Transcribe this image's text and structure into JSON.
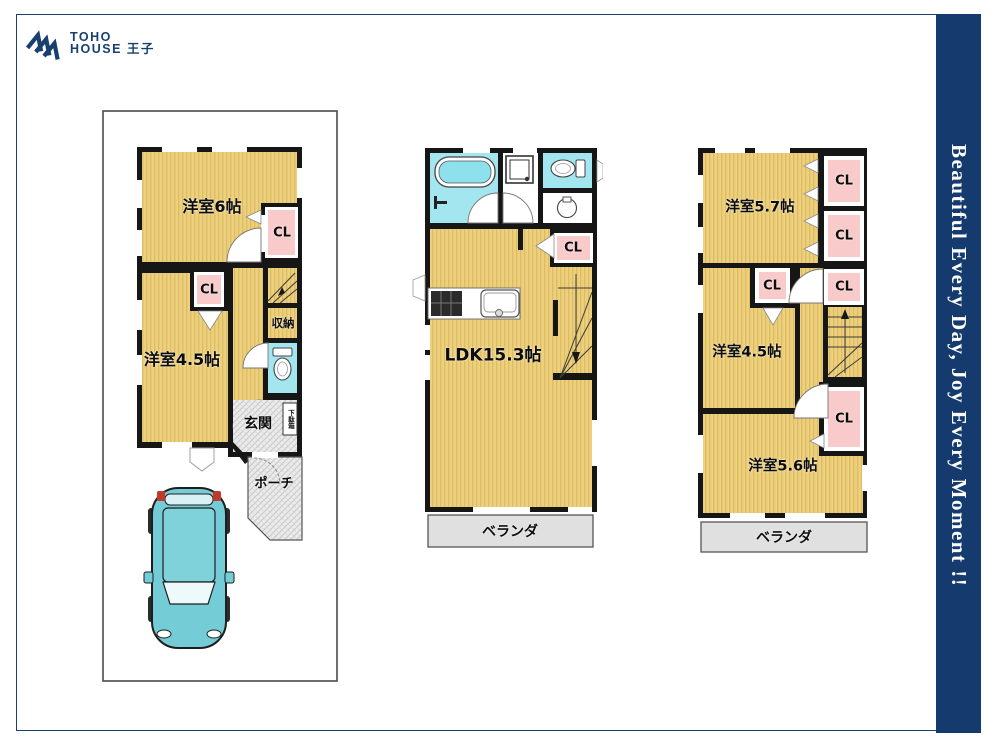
{
  "brand": {
    "line1": "TOHO",
    "line2": "HOUSE 王子"
  },
  "side_banner": {
    "text": "Beautiful  Every Day, Joy Every Moment !!"
  },
  "colors": {
    "navy": "#143a6e",
    "wall": "#161616",
    "room_floor": "#edd07e",
    "room_stripe": "#debd62",
    "closet_pink": "#f8caca",
    "water_cyan": "#a4e6ef",
    "veranda_gray": "#e0e0e0",
    "car_teal": "#74ccd6"
  },
  "floor1": {
    "room6": "洋室6帖",
    "closets": [
      "CL",
      "CL"
    ],
    "room45": "洋室4.5帖",
    "storage": "収納",
    "entrance": "玄関",
    "shoebox": "下駄箱",
    "porch": "ポーチ"
  },
  "floor2": {
    "ldk": "LDK15.3帖",
    "closet": "CL",
    "veranda": "ベランダ"
  },
  "floor3": {
    "room57": "洋室5.7帖",
    "closets": [
      "CL",
      "CL",
      "CL",
      "CL",
      "CL"
    ],
    "room45": "洋室4.5帖",
    "room56": "洋室5.6帖",
    "veranda": "ベランダ"
  }
}
